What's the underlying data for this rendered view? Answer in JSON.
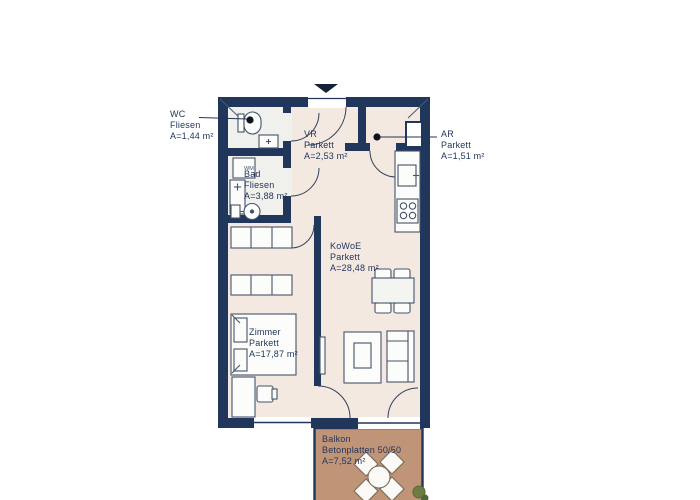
{
  "plan": {
    "type_label": "floor-plan",
    "colors": {
      "wall": "#20365a",
      "parkett_floor": "#f3e9e0",
      "fliesen_floor": "#f0f0ec",
      "balcony_floor": "#c09577",
      "label_text": "#22355c",
      "furniture_outline": "#45536c",
      "furniture_fill": "#fcfcfa"
    },
    "rooms": [
      {
        "id": "wc",
        "name": "WC",
        "material": "Fliesen",
        "area": "A=1,44 m²"
      },
      {
        "id": "bad",
        "name": "Bad",
        "material": "Fliesen",
        "area": "A=3,88 m²"
      },
      {
        "id": "vr",
        "name": "VR",
        "material": "Parkett",
        "area": "A=2,53 m²"
      },
      {
        "id": "ar",
        "name": "AR",
        "material": "Parkett",
        "area": "A=1,51 m²"
      },
      {
        "id": "kowoe",
        "name": "KoWoE",
        "material": "Parkett",
        "area": "A=28,48 m²"
      },
      {
        "id": "zimmer",
        "name": "Zimmer",
        "material": "Parkett",
        "area": "A=17,87 m²"
      },
      {
        "id": "balkon",
        "name": "Balkon",
        "material": "Betonplatten 50/50",
        "area": "A=7,52 m²"
      }
    ],
    "fixtures": {
      "wm_label": "WM"
    }
  }
}
